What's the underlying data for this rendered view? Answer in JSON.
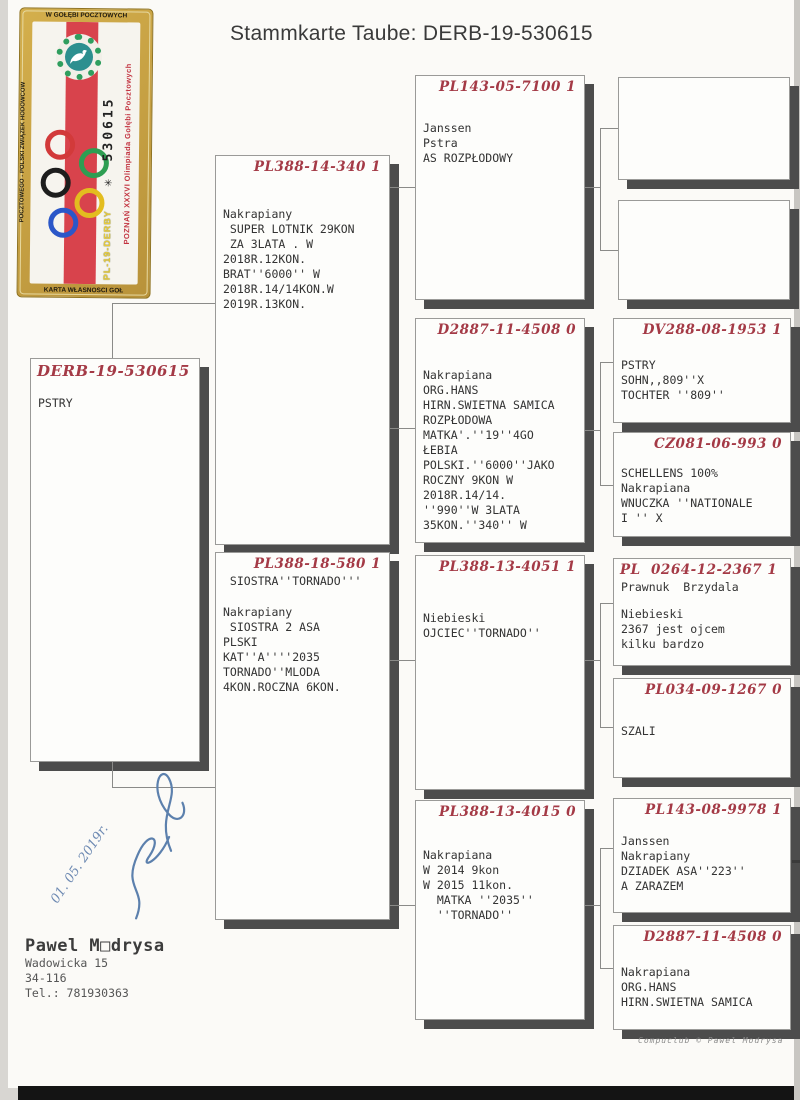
{
  "title": "Stammkarte Taube: DERB-19-530615",
  "stamp": {
    "border_top": "W GOŁĘBI POCZTOWYCH",
    "border_left": "POCZTOWEGO - POLSKI ZWIĄZEK HODOWCÓW",
    "border_bottom": "KARTA WŁASNOŚCI GOŁ",
    "olympiad": "POZNAŃ XXXVI Olimpiada Gołębi Pocztowych",
    "derby": "PL-19-DERBY",
    "serial": "✳ 530615",
    "colors": {
      "gold": "#c9a43e",
      "flag_red": "#d8434c",
      "wreath_green": "#2f9e5e"
    }
  },
  "boxes": [
    {
      "header": "DERB-19-530615",
      "body": "PSTRY"
    },
    {
      "header": "PL388-14-340 1",
      "body": "Nakrapiany\n SUPER LOTNIK 29KON\n ZA 3LATA . W\n2018R.12KON.\nBRAT''6000'' W\n2018R.14/14KON.W\n2019R.13KON."
    },
    {
      "header": "PL388-18-580 1",
      "sub": " SIOSTRA''TORNADO'''",
      "body": "Nakrapiany\n SIOSTRA 2 ASA\nPLSKI\nKAT''A''''2035\nTORNADO''MLODA\n4KON.ROCZNA 6KON."
    },
    {
      "header": "PL143-05-7100 1",
      "body": "Janssen\nPstra\nAS ROZPŁODOWY"
    },
    {
      "header": "D2887-11-4508 0",
      "body": "Nakrapiana\nORG.HANS\nHIRN.SWIETNA SAMICA\nROZPŁODOWA\nMATKA'.''19''4GO\nŁEBIA\nPOLSKI.''6000''JAKO\nROCZNY 9KON W\n2018R.14/14.\n''990''W 3LATA\n35KON.''340'' W"
    },
    {
      "header": "PL388-13-4051 1",
      "body": "Niebieski\nOJCIEC''TORNADO''"
    },
    {
      "header": "PL388-13-4015 0",
      "body": "Nakrapiana\nW 2014 9kon\nW 2015 11kon.\n  MATKA ''2035''\n  ''TORNADO''"
    },
    {},
    {},
    {
      "header": "DV288-08-1953 1",
      "body": "PSTRY\nSOHN,,809''X\nTOCHTER ''809''"
    },
    {
      "header": "CZ081-06-993 0",
      "body": "SCHELLENS 100%\nNakrapiana\nWNUCZKA ''NATIONALE\nI '' X"
    },
    {
      "header": "PL  0264-12-2367 1",
      "sub": "Prawnuk  Brzydala",
      "body": "Niebieski\n2367 jest ojcem\nkilku bardzo"
    },
    {
      "header": "PL034-09-1267 0",
      "body": "SZALI"
    },
    {
      "header": "PL143-08-9978 1",
      "body": "Janssen\nNakrapiany\nDZIADEK ASA''223''\nA ZARAZEM"
    },
    {
      "header": "D2887-11-4508 0",
      "body": "Nakrapiana\nORG.HANS\nHIRN.SWIETNA SAMICA"
    }
  ],
  "handwriting": {
    "date": "01. 05. 2019r."
  },
  "footer": {
    "name": "Pawel M□drysa",
    "address1": "Wadowicka 15",
    "address2": "34-116",
    "phone": "Tel.: 781930363",
    "credit": "Compuclub © Pawel Modrysa"
  }
}
